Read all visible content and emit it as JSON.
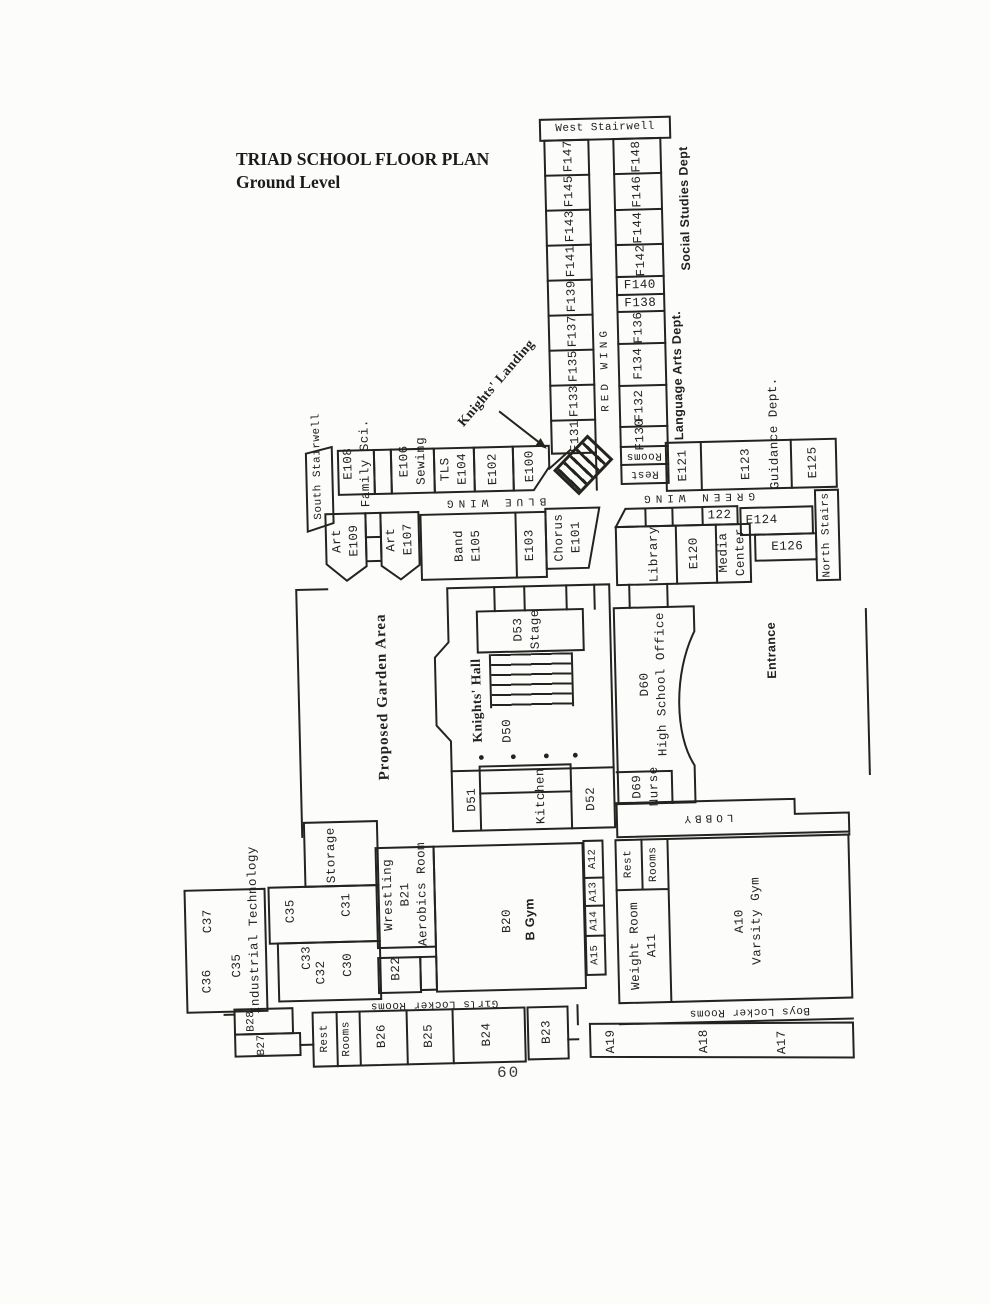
{
  "page": {
    "title_line1": "TRIAD SCHOOL FLOOR PLAN",
    "title_line2": "Ground Level",
    "page_number": "60"
  },
  "stairwells": {
    "west": "West Stairwell",
    "south": "South Stairwell",
    "north": "North Stairs",
    "knights_landing": "Knights' Landing"
  },
  "corridors": {
    "red_wing": "RED WING",
    "blue_wing": "BLUE WING",
    "green_wing": "GREEN WING",
    "lobby": "LOBBY"
  },
  "departments": {
    "social_studies": "Social Studies Dept",
    "language_arts": "Language Arts Dept.",
    "guidance": "Guidance Dept."
  },
  "red_wing": {
    "west_rooms": [
      "F147",
      "F145",
      "F143",
      "F141",
      "F139",
      "F137",
      "F135",
      "F133",
      "F131"
    ],
    "east_rooms": [
      "F148",
      "F146",
      "F144",
      "F142",
      "F140",
      "F138",
      "F136",
      "F134",
      "F132",
      "F130"
    ],
    "rest": "Rest",
    "rooms": "Rooms"
  },
  "blue_wing": {
    "e108": "E108",
    "family_sci": "Family Sci.",
    "e106": "E106",
    "sewing": "Sewing",
    "tls": "TLS",
    "e104": "E104",
    "e102": "E102",
    "e100": "E100",
    "art_a": "Art",
    "e109": "E109",
    "art_b": "Art",
    "e107": "E107",
    "band": "Band",
    "e105": "E105",
    "e103": "E103",
    "chorus": "Chorus",
    "e101": "E101"
  },
  "green_wing": {
    "e121": "E121",
    "e123": "E123",
    "e125": "E125",
    "room122": "122",
    "library": "Library",
    "e120": "E120",
    "media_line1": "Media",
    "media_line2": "Center",
    "e124": "E124",
    "e126": "E126"
  },
  "center": {
    "garden": "Proposed Garden Area",
    "knights_hall": "Knights' Hall",
    "d50": "D50",
    "d53": "D53",
    "stage": "Stage",
    "d51": "D51",
    "kitchen": "Kitchen",
    "d52": "D52",
    "d60": "D60",
    "hs_office": "High School Office",
    "d69": "D69",
    "nurse": "Nurse",
    "entrance": "Entrance"
  },
  "c_wing": {
    "c37": "C37",
    "c36": "C36",
    "c35": "C35",
    "industrial_technology": "Industrial Technology",
    "storage": "Storage",
    "c35b": "C35",
    "c31": "C31",
    "c33": "C33",
    "c32": "C32",
    "c30": "C30"
  },
  "b_wing": {
    "wrestling": "Wrestling",
    "b21": "B21",
    "aerobics": "Aerobics Room",
    "b22": "B22",
    "b20": "B20",
    "b_gym": "B Gym",
    "girls_locker": "Girls Locker Rooms",
    "rest": "Rest",
    "rooms": "Rooms",
    "b26": "B26",
    "b25": "B25",
    "b24": "B24",
    "b23": "B23",
    "b28": "B28",
    "b27": "B27"
  },
  "a_wing": {
    "a12": "A12",
    "a13": "A13",
    "a14": "A14",
    "a15": "A15",
    "rest": "Rest",
    "rooms": "Rooms",
    "weight_room": "Weight Room",
    "a11": "A11",
    "a10": "A10",
    "varsity_gym": "Varsity Gym",
    "boys_locker": "Boys Locker Rooms",
    "a19": "A19",
    "a18": "A18",
    "a17": "A17"
  },
  "colors": {
    "ink": "#242320",
    "paper": "#fcfcfa"
  }
}
